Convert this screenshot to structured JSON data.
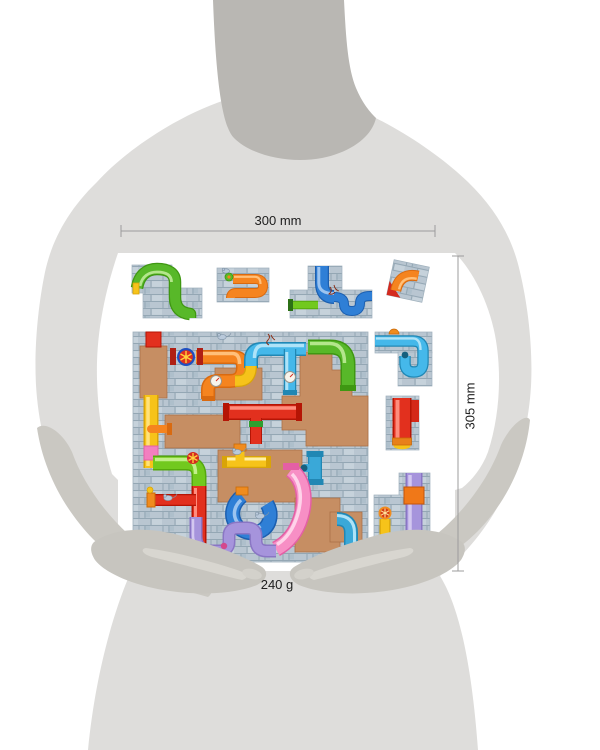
{
  "annotations": {
    "width_label": "300 mm",
    "height_label": "305 mm",
    "weight_label": "240 g"
  },
  "figure": {
    "head_color": "#b9b7b3",
    "body_color": "#dedddb",
    "forearm_color": "#cac8c2",
    "hand_color": "#c7c5bf"
  },
  "product": {
    "type": "pipes-puzzle-board-photo",
    "board_brick_color": "#b9c6d1",
    "cork_color": "#c68e63",
    "pipe_colors": [
      "#f5841f",
      "#45b8ea",
      "#58b829",
      "#f6c31a",
      "#e2301e",
      "#f78fc5",
      "#a694dc",
      "#2f7fd6",
      "#72c91e",
      "#3aa8d8"
    ]
  },
  "dimension_line_color": "#9c9c9c",
  "label_text_color": "#202020"
}
